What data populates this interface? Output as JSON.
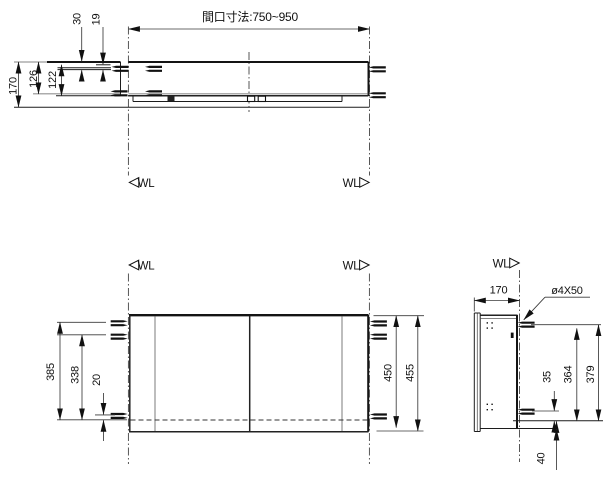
{
  "labels": {
    "wall_line": "WL"
  },
  "top_view": {
    "opening_dim": "間口寸法:750~950",
    "d30": "30",
    "d19": "19",
    "d170": "170",
    "d126": "126",
    "d122": "122"
  },
  "front_view": {
    "d385": "385",
    "d338": "338",
    "d20": "20",
    "d450": "450",
    "d455": "455"
  },
  "side_view": {
    "d170": "170",
    "screw_note": "ø4X50",
    "d35": "35",
    "d364": "364",
    "d379": "379",
    "d40": "40"
  }
}
